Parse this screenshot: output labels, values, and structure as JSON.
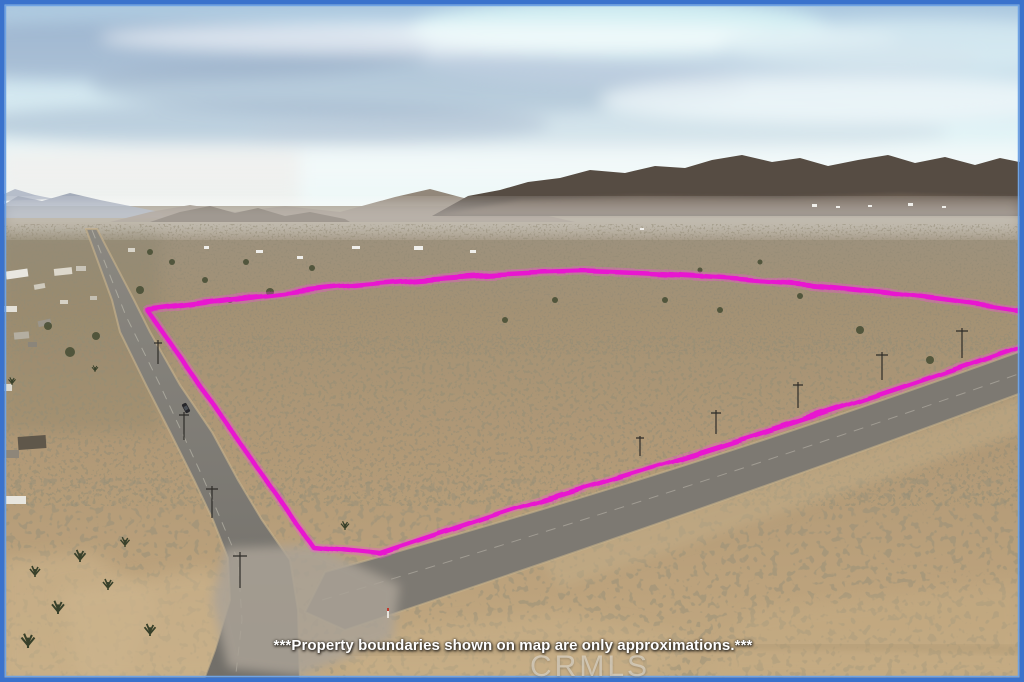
{
  "annotations": {
    "disclaimer_text": "***Property boundaries shown on map are only approximations.***",
    "watermark_text": "CRMLS",
    "boundary_color": "#e818d0",
    "boundary_glow_color": "#ff4ae0",
    "frame_outer_color": "#3a72cc",
    "frame_inner_color": "#6fa3e4"
  }
}
